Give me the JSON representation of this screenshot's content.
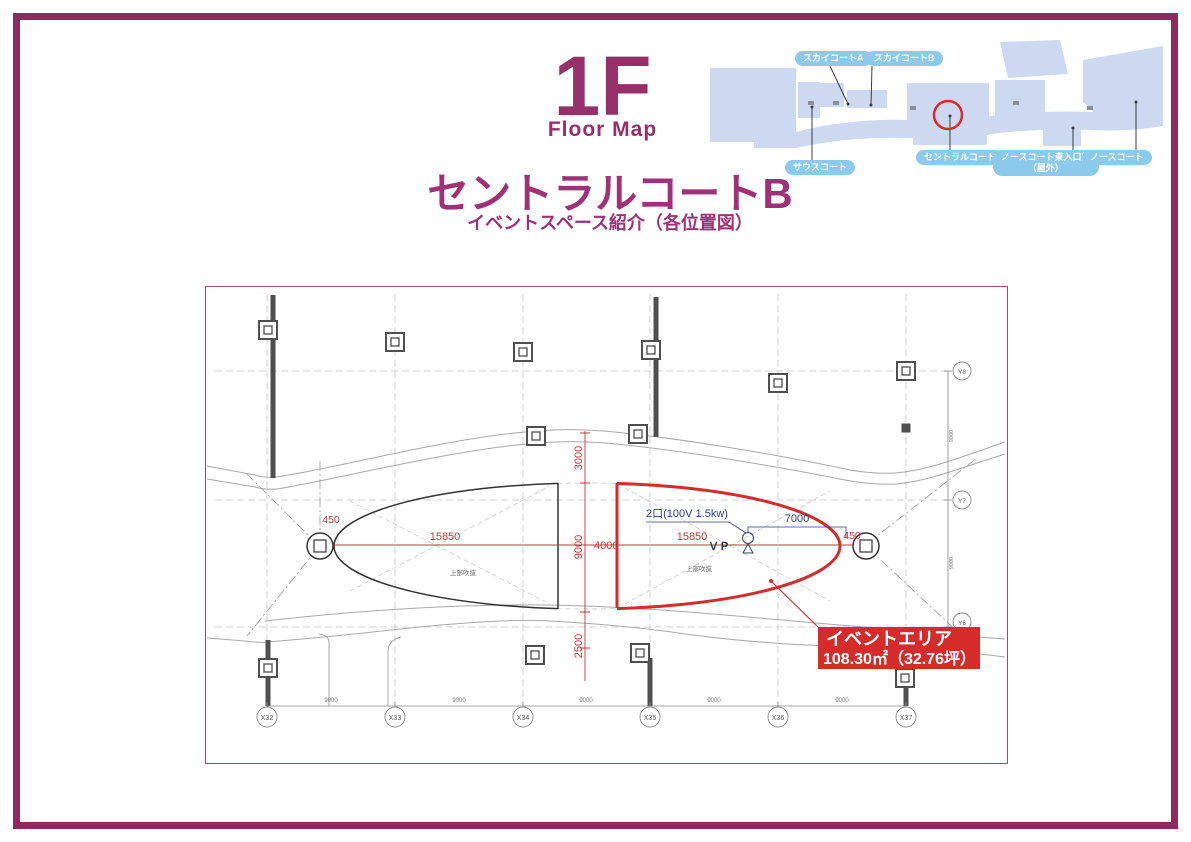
{
  "header": {
    "floor": "1F",
    "floor_caption": "Floor Map",
    "title": "セントラルコートB",
    "subtitle": "イベントスペース紹介（各位置図）"
  },
  "minimap": {
    "labels": {
      "sky_a": "スカイコートA",
      "sky_b": "スカイコートB",
      "south": "サウスコート",
      "central": "セントラルコート",
      "north_east_l1": "ノースコート東入口前",
      "north_east_l2": "（屋外）",
      "north": "ノースコート"
    },
    "highlight_color": "#e02828"
  },
  "drawing": {
    "event_area": {
      "name": "イベントエリア",
      "size": "108.30㎡（32.76坪）"
    },
    "labels": {
      "power": "2口(100V 1.5kw)",
      "vp": "ＶＰ",
      "void1": "上部吹抜",
      "void2": "上部吹抜"
    },
    "dims": {
      "d3000": "3000",
      "d9000_mid": "9000",
      "d2500": "2500",
      "d4000": "4000",
      "d15850_left": "15850",
      "d15850_right": "15850",
      "d450_left": "450",
      "d450_right": "450",
      "d7000": "7000"
    },
    "x_axis": [
      "X32",
      "X33",
      "X34",
      "X35",
      "X36",
      "X37"
    ],
    "x_spans": [
      "9000",
      "9000",
      "9000",
      "9000",
      "9000"
    ],
    "y_axis": [
      "Y8",
      "Y7",
      "Y6"
    ],
    "y_spans": [
      "9000",
      "9000"
    ]
  },
  "colors": {
    "frame": "#8d2a5f",
    "title": "#a03077",
    "map_fill": "#ccd9f1",
    "pill": "#8ccaec",
    "red": "#d62b2b",
    "dim_red": "#cc3333",
    "dim_blue": "#2c3c92"
  }
}
